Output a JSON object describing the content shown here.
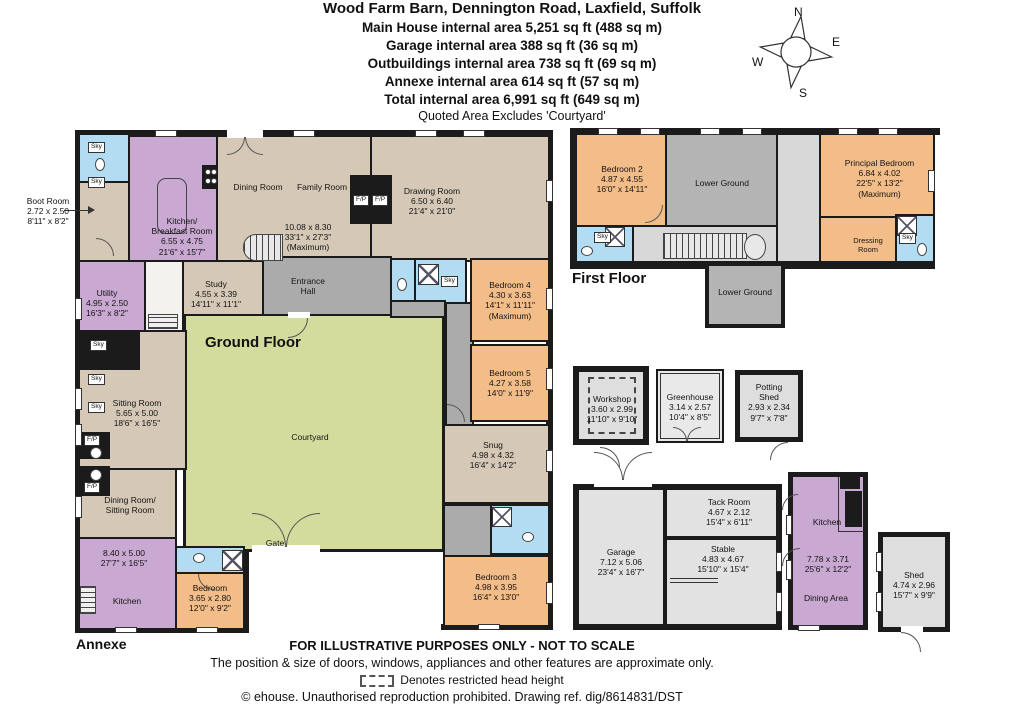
{
  "header": {
    "title": "Wood Farm Barn, Dennington Road, Laxfield, Suffolk",
    "area_lines": [
      "Main House internal area 5,251 sq ft (488 sq m)",
      "Garage internal area 388 sq ft (36 sq m)",
      "Outbuildings internal area 738 sq ft (69 sq m)",
      "Annexe internal area 614 sq ft (57 sq m)",
      "Total internal area 6,991 sq ft (649 sq m)"
    ],
    "note": "Quoted Area Excludes 'Courtyard'"
  },
  "compass": {
    "north": "N",
    "east": "E",
    "south": "S",
    "west": "W"
  },
  "floor_titles": {
    "ground": "Ground Floor",
    "first": "First Floor",
    "annexe": "Annexe"
  },
  "rooms": {
    "boot_room": [
      "Boot Room",
      "2.72 x 2.50",
      "8'11\" x 8'2\""
    ],
    "kitchen_breakfast": [
      "Kitchen/",
      "Breakfast Room",
      "6.55 x 4.75",
      "21'6\" x 15'7\""
    ],
    "dining_room": [
      "Dining Room"
    ],
    "family_room": [
      "Family Room"
    ],
    "dining_family_dims": [
      "10.08 x 8.30",
      "33'1\" x 27'3\"",
      "(Maximum)"
    ],
    "drawing_room": [
      "Drawing Room",
      "6.50 x 6.40",
      "21'4\" x 21'0\""
    ],
    "study": [
      "Study",
      "4.55 x 3.39",
      "14'11\" x 11'1\""
    ],
    "entrance_hall": [
      "Entrance",
      "Hall"
    ],
    "utility": [
      "Utility",
      "4.95 x 2.50",
      "16'3\" x 8'2\""
    ],
    "sitting_room": [
      "Sitting Room",
      "5.65 x 5.00",
      "18'6\" x 16'5\""
    ],
    "courtyard": [
      "Courtyard"
    ],
    "gate": [
      "Gate"
    ],
    "bedroom4": [
      "Bedroom 4",
      "4.30 x 3.63",
      "14'1\" x 11'11\"",
      "(Maximum)"
    ],
    "bedroom5": [
      "Bedroom 5",
      "4.27 x 3.58",
      "14'0\" x 11'9\""
    ],
    "snug": [
      "Snug",
      "4.98 x 4.32",
      "16'4\" x 14'2\""
    ],
    "bedroom3": [
      "Bedroom 3",
      "4.98 x 3.95",
      "16'4\" x 13'0\""
    ],
    "annexe_dining_sitting": [
      "Dining Room/",
      "Sitting Room"
    ],
    "annexe_dims": [
      "8.40 x 5.00",
      "27'7\" x 16'5\""
    ],
    "annexe_kitchen": [
      "Kitchen"
    ],
    "annexe_bedroom": [
      "Bedroom",
      "3.65 x 2.80",
      "12'0\" x 9'2\""
    ],
    "bedroom2": [
      "Bedroom 2",
      "4.87 x 4.55",
      "16'0\" x 14'11\""
    ],
    "lower_ground": [
      "Lower Ground"
    ],
    "principal_bedroom": [
      "Principal Bedroom",
      "6.84 x 4.02",
      "22'5\" x 13'2\"",
      "(Maximum)"
    ],
    "dressing_room": [
      "Dressing",
      "Room"
    ],
    "workshop": [
      "Workshop",
      "3.60 x 2.99",
      "11'10\" x 9'10\""
    ],
    "greenhouse": [
      "Greenhouse",
      "3.14 x 2.57",
      "10'4\" x 8'5\""
    ],
    "potting_shed": [
      "Potting",
      "Shed",
      "2.93 x 2.34",
      "9'7\" x 7'8\""
    ],
    "garage": [
      "Garage",
      "7.12 x 5.06",
      "23'4\" x 16'7\""
    ],
    "tack_room": [
      "Tack Room",
      "4.67 x 2.12",
      "15'4\" x 6'11\""
    ],
    "stable": [
      "Stable",
      "4.83 x 4.67",
      "15'10\" x 15'4\""
    ],
    "outbuilding_kitchen": [
      "Kitchen"
    ],
    "outbuilding_kitchen_dims": [
      "7.78 x 3.71",
      "25'6\" x 12'2\""
    ],
    "dining_area": [
      "Dining Area"
    ],
    "shed": [
      "Shed",
      "4.74 x 2.96",
      "15'7\" x 9'9\""
    ]
  },
  "misc": {
    "sky": "Sky",
    "fp": "F/P"
  },
  "footer": {
    "line1": "FOR ILLUSTRATIVE PURPOSES ONLY - NOT TO SCALE",
    "line2": "The position & size of doors, windows, appliances and other features are approximate only.",
    "line3": "Denotes restricted head height",
    "line4": "© ehouse. Unauthorised reproduction prohibited. Drawing ref. dig/8614831/DST"
  },
  "colors": {
    "wall": "#1b1b1b",
    "tan": "#d5c8b6",
    "purple": "#c9a8d2",
    "orange": "#f3bd89",
    "blue": "#b2dcf2",
    "green": "#d3dc9d",
    "hallgray": "#ababab",
    "lggray": "#b4b4b4",
    "ltgray": "#d8d8d8",
    "outgray": "#dedede"
  }
}
